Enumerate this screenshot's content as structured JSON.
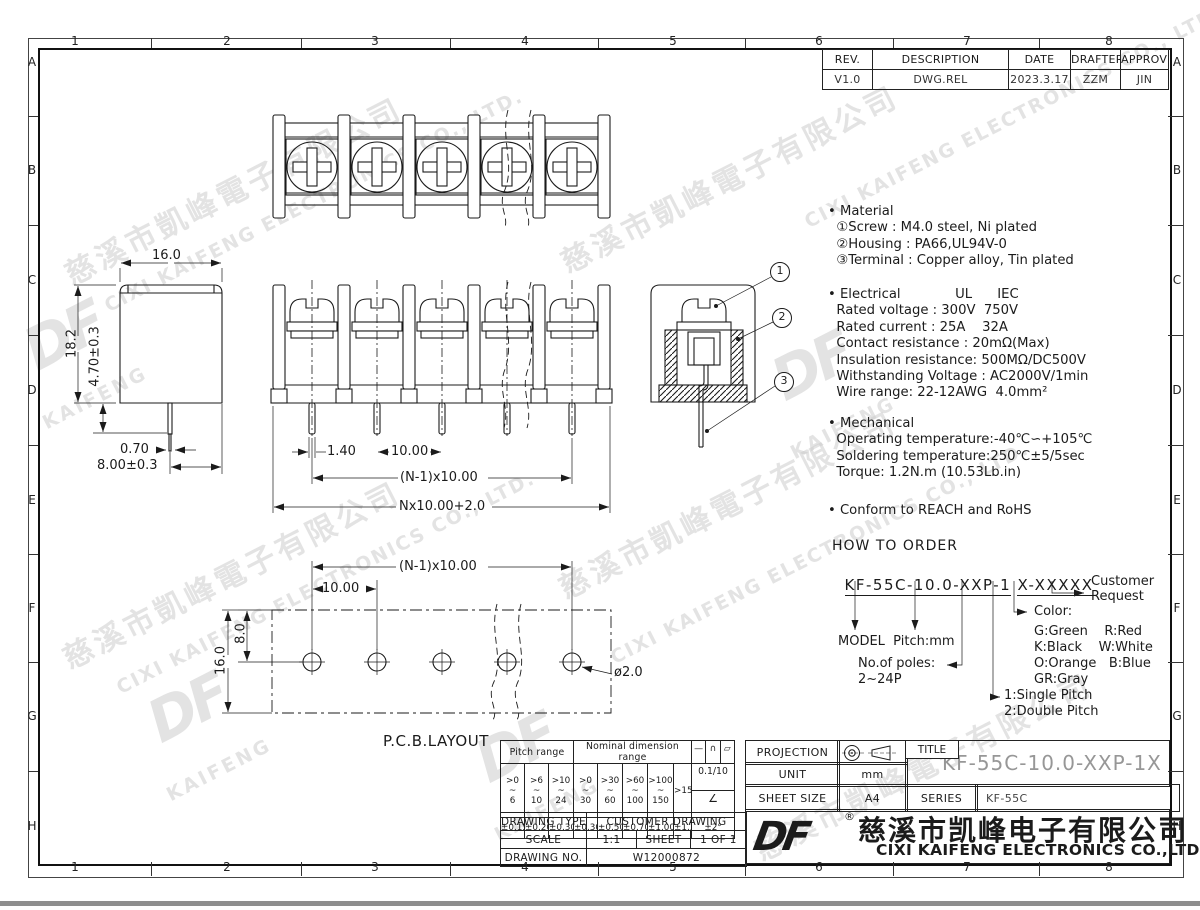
{
  "grid": {
    "cols": [
      "1",
      "2",
      "3",
      "4",
      "5",
      "6",
      "7",
      "8"
    ],
    "rows": [
      "A",
      "B",
      "C",
      "D",
      "E",
      "F",
      "G",
      "H"
    ]
  },
  "revision": {
    "headers": [
      "REV.",
      "DESCRIPTION",
      "DATE",
      "DRAFTER",
      "APPROVER"
    ],
    "values": [
      "V1.0",
      "DWG.REL",
      "2023.3.17",
      "ZZM",
      "JIN"
    ]
  },
  "specs": {
    "material": [
      "• Material",
      "  ①Screw : M4.0 steel, Ni plated",
      "  ②Housing : PA66,UL94V-0",
      "  ③Terminal : Copper alloy, Tin plated"
    ],
    "electrical": [
      "• Electrical             UL      IEC",
      "  Rated voltage : 300V  750V",
      "  Rated current : 25A    32A",
      "  Contact resistance : 20mΩ(Max)",
      "  Insulation resistance: 500MΩ/DC500V",
      "  Withstanding Voltage : AC2000V/1min",
      "  Wire range: 22-12AWG  4.0mm²"
    ],
    "mechanical": [
      "• Mechanical",
      "  Operating temperature:-40℃∽+105℃",
      "  Soldering temperature:250℃±5/5sec",
      "  Torque: 1.2N.m (10.53Lb.in)"
    ],
    "conform": "• Conform to REACH and RoHS"
  },
  "order": {
    "heading": "HOW TO ORDER",
    "code_main": "KF-55C-10.0-XXP-1",
    "code_suffix": "X-XXXXX",
    "customer": "Customer\nRequest",
    "color_title": "Color:",
    "colors": [
      "G:Green    R:Red",
      "K:Black    W:White",
      "O:Orange   B:Blue",
      "GR:Gray"
    ],
    "model": "MODEL  Pitch:mm",
    "poles_label": "No.of poles:",
    "poles_range": "2~24P",
    "pitch_single": "1:Single Pitch",
    "pitch_double": "2:Double Pitch"
  },
  "dims": {
    "front": [
      "1.40",
      "10.00",
      "(N-1)x10.00",
      "Nx10.00+2.0"
    ],
    "side": [
      "16.0",
      "18.2",
      "4.70±0.3",
      "0.70",
      "8.00±0.3"
    ],
    "pcb": [
      "(N-1)x10.00",
      "10.00",
      "8.0",
      "16.0",
      "ø2.0"
    ],
    "pcb_label": "P.C.B.LAYOUT"
  },
  "callouts": [
    "1",
    "2",
    "3"
  ],
  "tol": {
    "pitch_header": "Pitch range",
    "nominal_header": "Nominal dimension range",
    "symbols": [
      "—",
      "∩",
      "▱"
    ],
    "ranges": [
      ">0\n~\n6",
      ">6\n~\n10",
      ">10\n~\n24",
      ">0\n~\n30",
      ">30\n~\n60",
      ">60\n~\n100",
      ">100\n~\n150",
      ">150"
    ],
    "tols": [
      "±0.15",
      "±0.20",
      "±0.30",
      "±0.30",
      "±0.50",
      "±0.70",
      "±1.00",
      "±1.30"
    ],
    "flat_tol": "0.1/10",
    "angle_symbol": "∠",
    "angle_tol": "±2°"
  },
  "info": {
    "drawing_type_label": "DRAWING TYPE",
    "drawing_type": "CUSTOMER DRAWING",
    "scale_label": "SCALE",
    "scale": "1:1",
    "sheet_label": "SHEET",
    "sheet": "1 OF 1",
    "drawing_no_label": "DRAWING NO.",
    "drawing_no": "W12000872"
  },
  "title_block": {
    "projection_label": "PROJECTION",
    "title_label": "TITLE",
    "title": "KF-55C-10.0-XXP-1X",
    "unit_label": "UNIT",
    "unit": "mm",
    "sheet_size_label": "SHEET SIZE",
    "sheet_size": "A4",
    "series_label": "SERIES",
    "series": "KF-55C"
  },
  "company": {
    "logo": "DF",
    "reg": "®",
    "name_cn": "慈溪市凯峰电子有限公司",
    "name_en": "CIXI KAIFENG ELECTRONICS CO.,LTD"
  },
  "watermark": {
    "cn": "慈溪市凱峰電子有限公司",
    "en": "CIXI KAIFENG ELECTRONICS CO., LTD.",
    "logo": "DF",
    "logo_sub": "KAIFENG"
  }
}
